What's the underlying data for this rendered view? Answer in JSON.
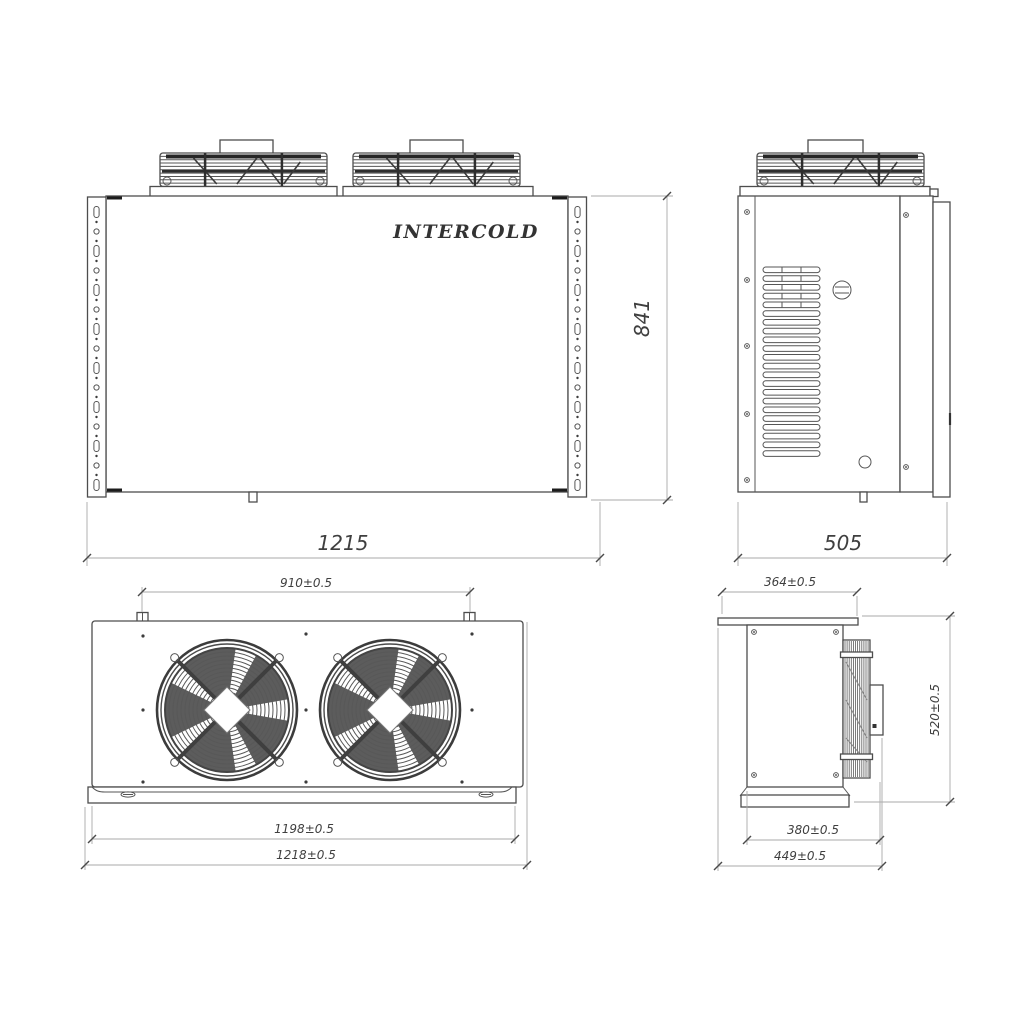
{
  "brand": "INTERCOLD",
  "colors": {
    "line": "#4d4d4d",
    "dim_line": "#aaaaaa",
    "dim_text": "#3f3f3f",
    "background": "#ffffff"
  },
  "views": {
    "front": {
      "width_mm": "1215",
      "height_mm": "841"
    },
    "side": {
      "depth_mm": "505"
    },
    "top": {
      "fan_mount_spacing": "910±0.5",
      "base_length": "1198±0.5",
      "overall_length": "1218±0.5"
    },
    "profile": {
      "top_depth": "364±0.5",
      "height": "520±0.5",
      "base_depth": "380±0.5",
      "overall_depth": "449±0.5"
    }
  }
}
